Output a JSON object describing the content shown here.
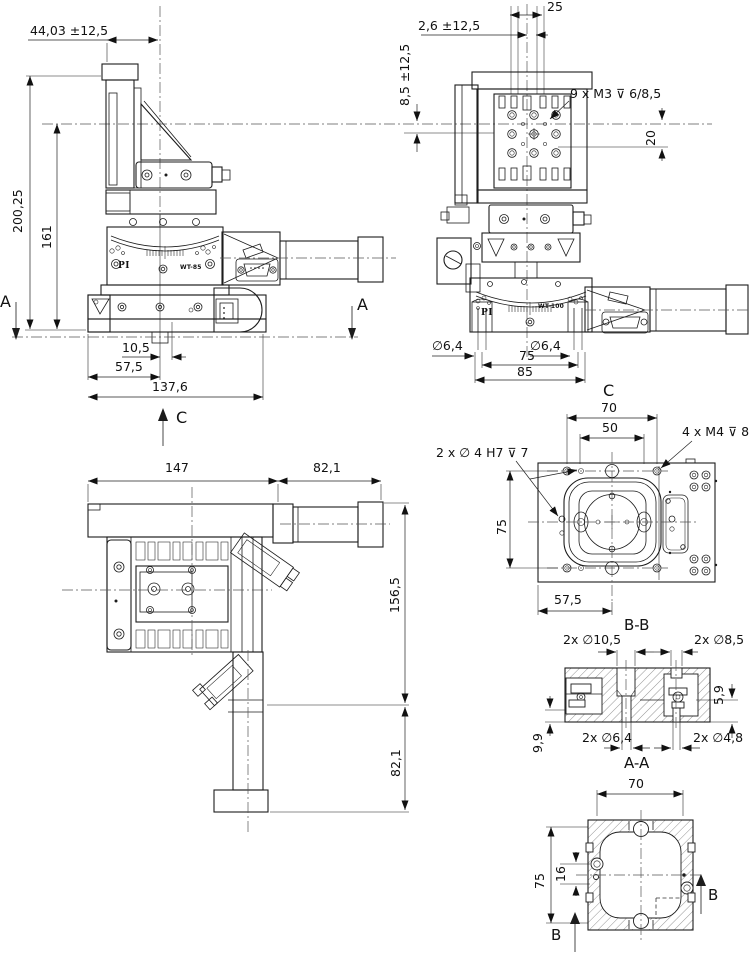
{
  "views": {
    "front": {
      "dims": {
        "d44": "44,03 ±12,5",
        "d200": "200,25",
        "d161": "161",
        "d105": "10,5",
        "d575": "57,5",
        "d1376": "137,6"
      },
      "labels": {
        "section_a_left": "A",
        "section_a_right": "A",
        "view_arrow_c": "C",
        "logo": "PI",
        "model": "WT-85"
      }
    },
    "side": {
      "dims": {
        "d25": "25",
        "d26": "2,6 ±12,5",
        "d85travel": "8,5 ±12,5",
        "thread_note": "9 x M3 ⊽ 6/8,5",
        "d20": "20",
        "hole_left": "∅6,4",
        "hole_right": "∅6,4",
        "d75": "75",
        "d85": "85"
      },
      "labels": {
        "logo": "PI",
        "model": "WT-100"
      }
    },
    "plan": {
      "dims": {
        "d147": "147",
        "d821_top": "82,1",
        "d1565": "156,5",
        "d821_right": "82,1"
      }
    },
    "view_c": {
      "title": "C",
      "dims": {
        "d70": "70",
        "d50": "50",
        "thread_note": "4 x M4 ⊽ 8",
        "dowel_note": "2 x ∅ 4 H7 ⊽ 7",
        "d75": "75",
        "d575": "57,5"
      }
    },
    "section_bb": {
      "title": "B-B",
      "dims": {
        "d105": "2x ∅10,5",
        "d85": "2x ∅8,5",
        "d59": "5,9",
        "d99": "9,9",
        "d64": "2x ∅6,4",
        "d48": "2x ∅4,8"
      }
    },
    "section_aa": {
      "title": "A-A",
      "dims": {
        "d70": "70",
        "d75": "75",
        "d16": "16"
      },
      "labels": {
        "arrow_b_bottom": "B",
        "arrow_b_right": "B"
      }
    }
  }
}
